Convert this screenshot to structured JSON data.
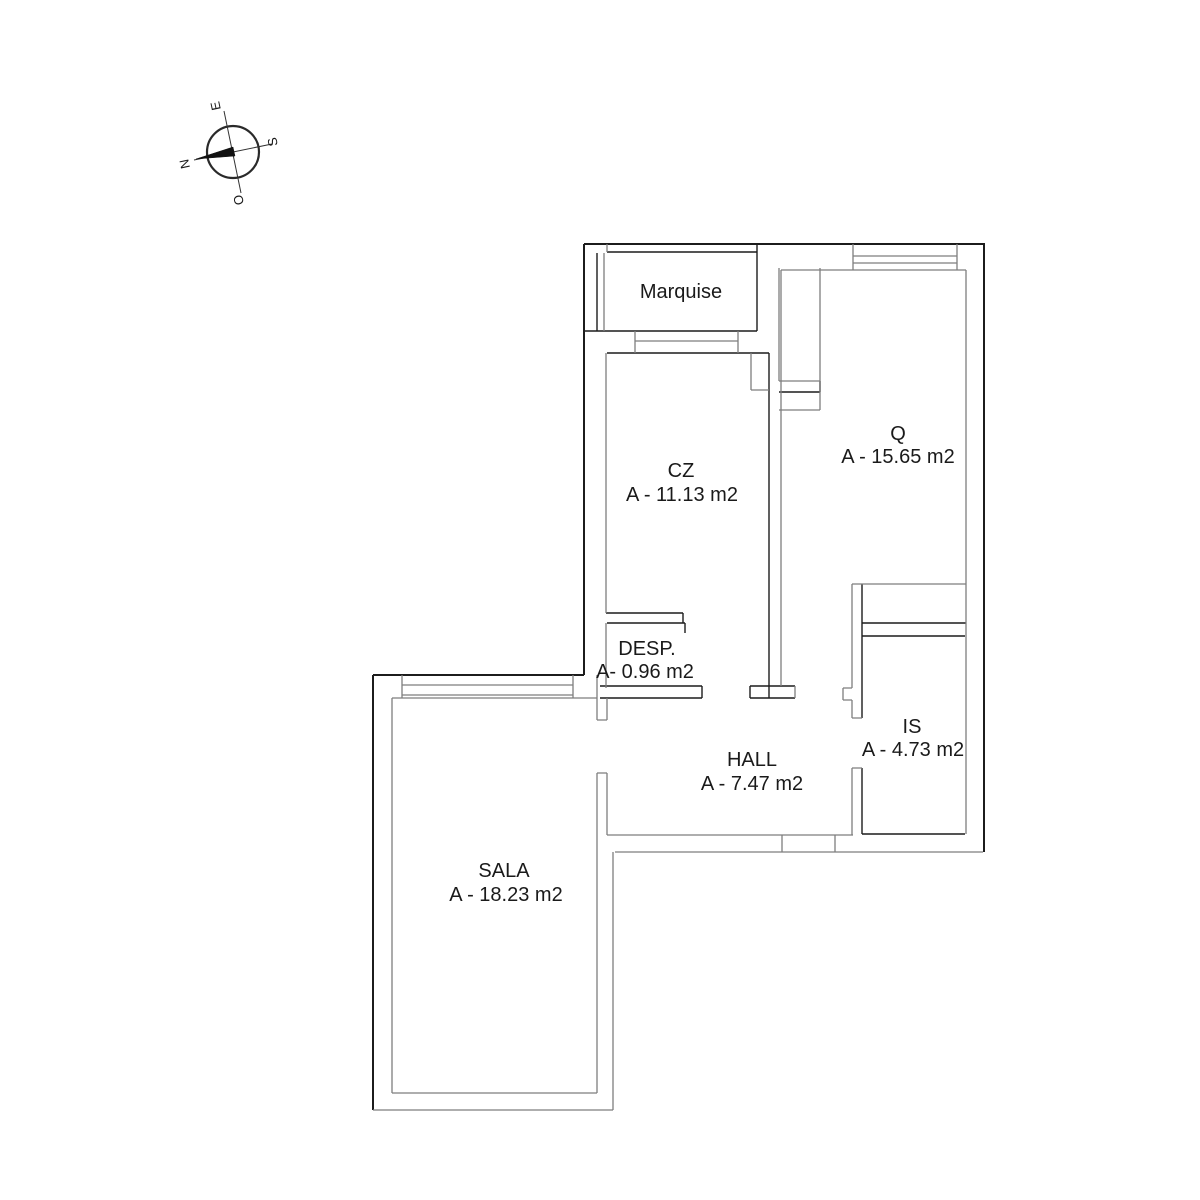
{
  "compass": {
    "north": "N",
    "south": "S",
    "east": "E",
    "west": "O"
  },
  "rooms": {
    "marquise": {
      "name": "Marquise",
      "area": ""
    },
    "cz": {
      "name": "CZ",
      "area": "A - 11.13 m2"
    },
    "q": {
      "name": "Q",
      "area": "A - 15.65 m2"
    },
    "desp": {
      "name": "DESP.",
      "area": "A- 0.96 m2"
    },
    "hall": {
      "name": "HALL",
      "area": "A - 7.47 m2"
    },
    "is": {
      "name": "IS",
      "area": "A - 4.73 m2"
    },
    "sala": {
      "name": "SALA",
      "area": "A - 18.23 m2"
    }
  },
  "colors": {
    "background": "#ffffff",
    "wall_dark": "#1c1c1c",
    "wall_gray": "#7e7e7e",
    "text": "#1a1a1a",
    "needle": "#111111"
  }
}
